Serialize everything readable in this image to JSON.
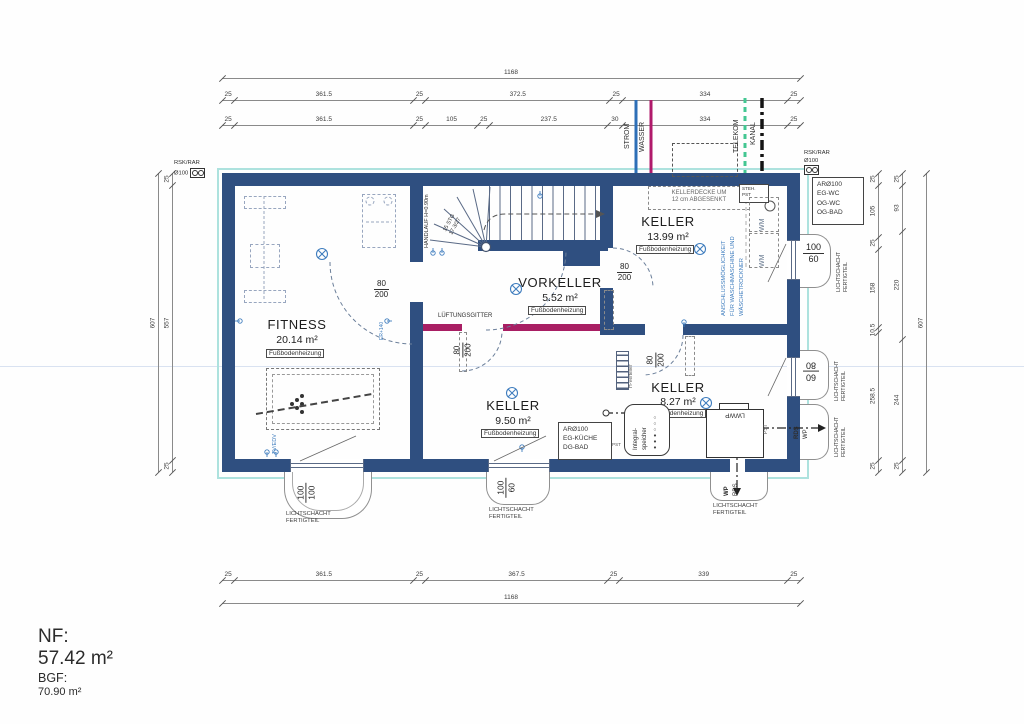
{
  "title_block": {
    "nf_label": "NF:",
    "nf_value": "57.42 m²",
    "bgf_label": "BGF:",
    "bgf_value": "70.90 m²"
  },
  "rooms": {
    "fitness": {
      "name": "FITNESS",
      "area": "20.14 m²",
      "heating": "Fußbodenheizung"
    },
    "vorkeller": {
      "name": "VORKELLER",
      "area": "5.52 m²",
      "heating": "Fußbodenheizung"
    },
    "keller_nord": {
      "name": "KELLER",
      "area": "13.99 m²",
      "heating": "Fußbodenheizung"
    },
    "keller_mitte": {
      "name": "KELLER",
      "area": "9.50 m²",
      "heating": "Fußbodenheizung"
    },
    "keller_sued": {
      "name": "KELLER",
      "area": "8.27 m²",
      "heating": "Fußbodenheizung"
    }
  },
  "doors": {
    "width": "80",
    "height": "200"
  },
  "stairs": {
    "handlauf": "HANDLAUF H=0.90m",
    "stg": "15 STG",
    "steigung": "17.3/27"
  },
  "utilities": {
    "strom": "STROM",
    "wasser": "WASSER",
    "telekom": "TELEKOM",
    "kanal": "KANAL"
  },
  "annotations": {
    "kellerdecke_1": "KELLERDECKE UM",
    "kellerdecke_2": "12 cm ABGESENKT",
    "anschluss_1": "ANSCHLUSSMÖGLICHKEIT",
    "anschluss_2": "FÜR WASCHMASCHINE UND",
    "anschluss_3": "WÄSCHETROCKNER",
    "lueftung": "LÜFTUNGSGITTER",
    "steh": "STEH.",
    "pst": "PST",
    "wm": "WM",
    "h_verteiler": "H-Verteiler",
    "integral_1": "Integral-",
    "integral_2": "speicher",
    "integral_dots": "●●●○○○",
    "lwwp": "LWWP",
    "rds": "RDS",
    "wp": "WP",
    "tv_edv": "TV/EDV",
    "er140": "ER+140"
  },
  "shafts": {
    "label_1": "LICHTSCHACHT",
    "label_2": "FERTIGTEIL",
    "s100": "100",
    "s60": "60",
    "s80": "80"
  },
  "ducts": {
    "rsk": "RSK/RAR",
    "rsk_d": "Ø100",
    "ar_kueche": {
      "l1": "ARØ100",
      "l2": "EG-KÜCHE",
      "l3": "DG-BAD"
    },
    "ar_wc": {
      "l1": "ARØ100",
      "l2": "EG-WC",
      "l3": "OG-WC",
      "l4": "OG-BAD"
    }
  },
  "dimensions": {
    "top_overall": [
      "1168"
    ],
    "top_row2": [
      "25",
      "361.5",
      "25",
      "372.5",
      "25",
      "334",
      "25"
    ],
    "top_row3": [
      "25",
      "361.5",
      "25",
      "105",
      "25",
      "237.5",
      "30",
      "334",
      "25"
    ],
    "bottom_row1": [
      "25",
      "361.5",
      "25",
      "367.5",
      "25",
      "339",
      "25"
    ],
    "bottom_overall": [
      "1168"
    ],
    "left_inner": [
      "25",
      "557",
      "25"
    ],
    "left_overall": [
      "607"
    ],
    "right_inner1": [
      "25",
      "105",
      "25",
      "158",
      "10.5",
      "258.5",
      "25"
    ],
    "right_inner2": [
      "25",
      "93",
      "220",
      "244",
      "25"
    ],
    "right_overall": [
      "607"
    ]
  }
}
